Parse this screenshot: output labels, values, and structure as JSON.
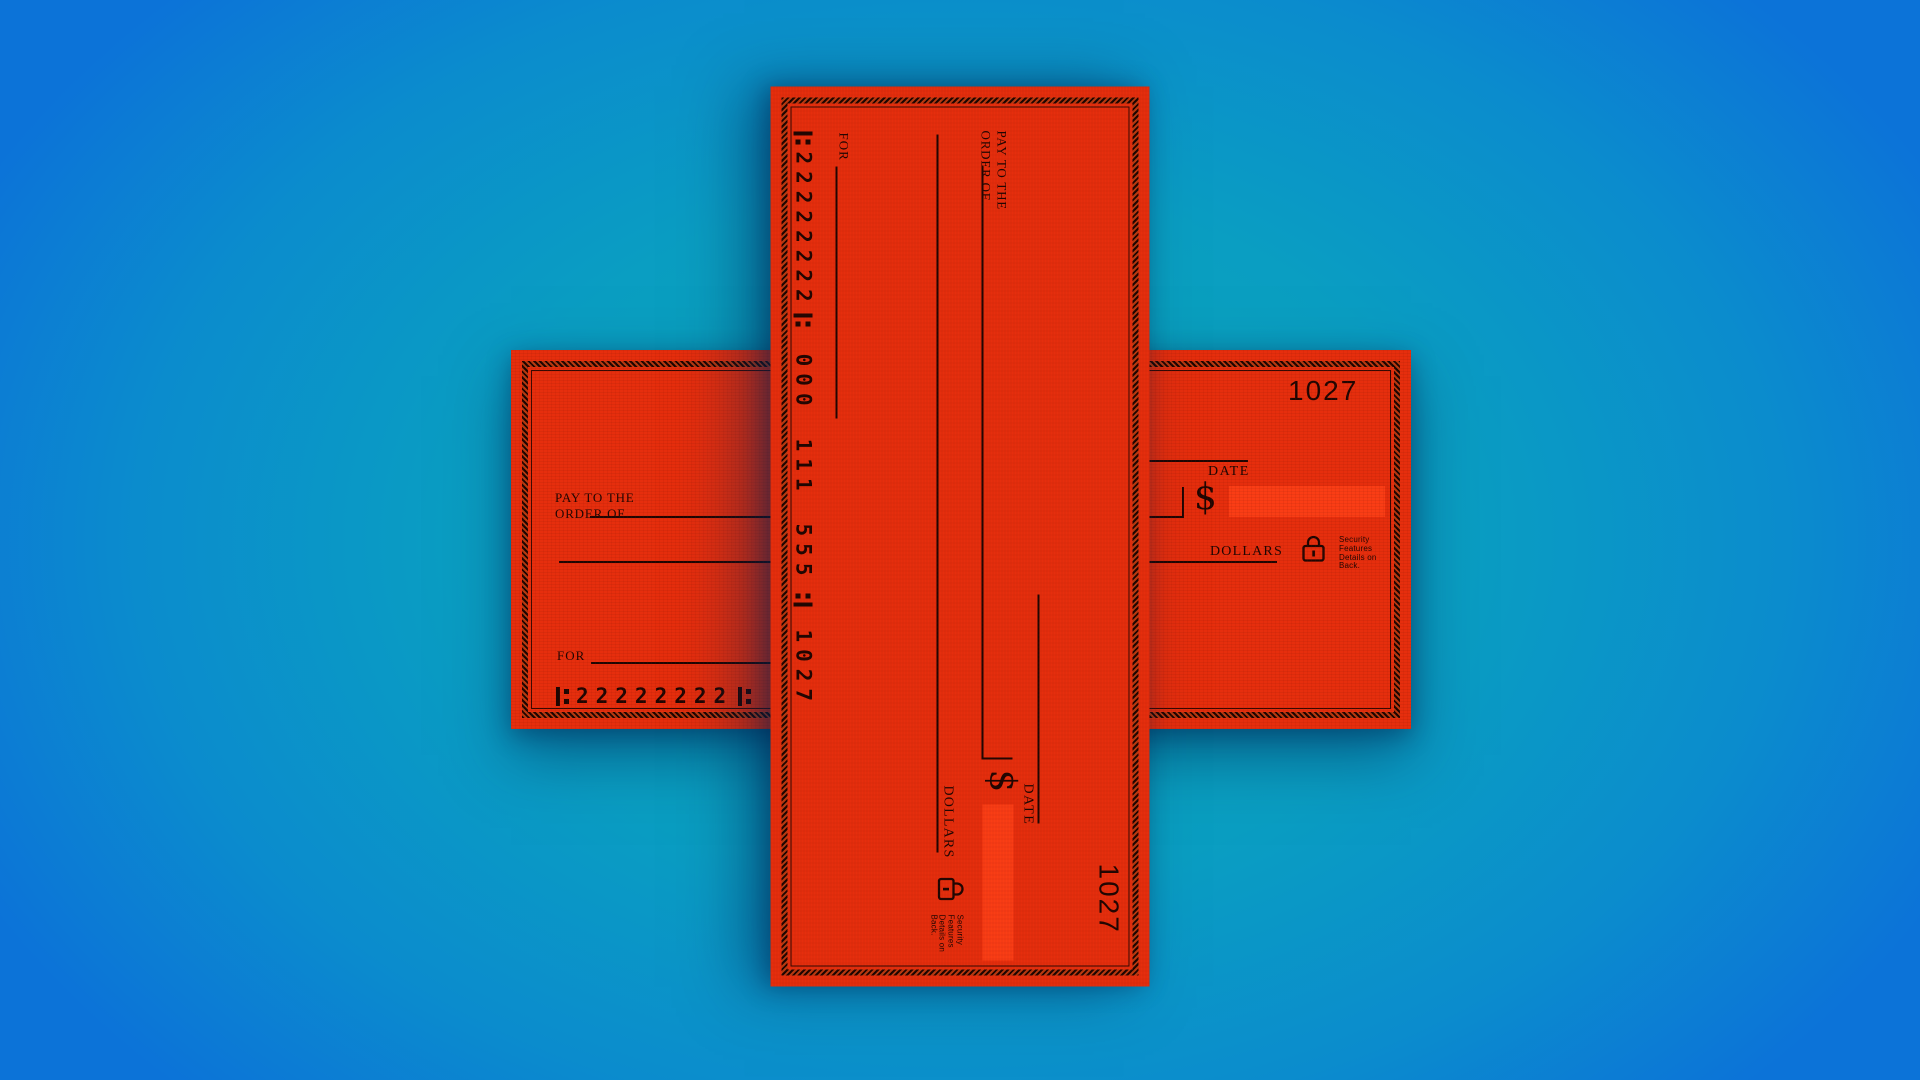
{
  "palette": {
    "bg_center": "#0ba8b6",
    "bg_mid": "#0a9ec2",
    "bg_edge": "#0c73d8",
    "red": "#e62e0d",
    "red_bright": "#fa3d15",
    "ink": "#1f0602",
    "border_dark": "#2a0701"
  },
  "check": {
    "number": "1027",
    "labels": {
      "pay_to_line1": "PAY TO THE",
      "pay_to_line2": "ORDER OF",
      "date": "DATE",
      "dollar_sign": "$",
      "dollars": "DOLLARS",
      "for": "FOR",
      "security": "Security Features Details on Back."
    },
    "micr": {
      "routing": "22222222",
      "account_groups": [
        "000",
        "111",
        "555"
      ],
      "check_number": "1027"
    }
  }
}
